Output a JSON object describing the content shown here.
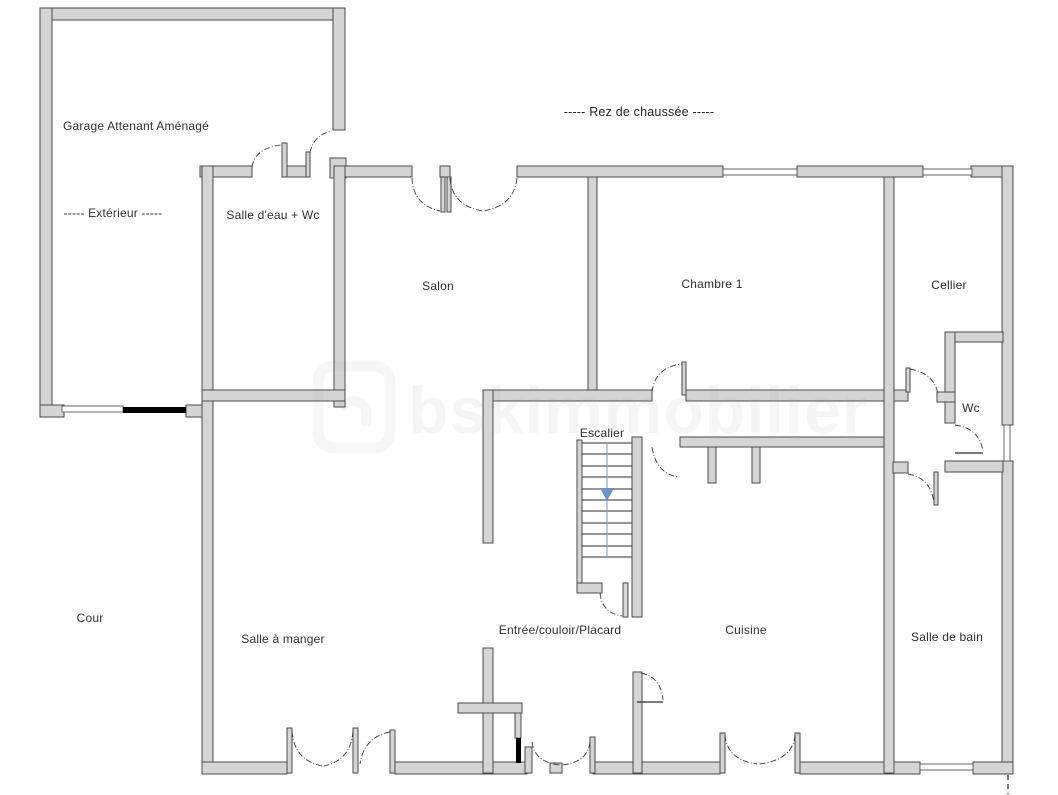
{
  "title": {
    "text": "-----  Rez de chaussée  -----"
  },
  "watermark": {
    "text": "bskimmobilier"
  },
  "rooms": {
    "garage": {
      "label": "Garage Attenant Aménagé"
    },
    "exterieur": {
      "label": "-----  Extérieur  -----"
    },
    "salle_deau": {
      "label": "Salle d'eau + Wc"
    },
    "salon": {
      "label": "Salon"
    },
    "chambre1": {
      "label": "Chambre 1"
    },
    "cellier": {
      "label": "Cellier"
    },
    "wc": {
      "label": "Wc"
    },
    "escalier": {
      "label": "Escalier"
    },
    "entree": {
      "label": "Entrée/couloir/Placard"
    },
    "cuisine": {
      "label": "Cuisine"
    },
    "salle_a_manger": {
      "label": "Salle à manger"
    },
    "salle_de_bain": {
      "label": "Salle de bain"
    },
    "cour": {
      "label": "Cour"
    }
  },
  "colors": {
    "wall_fill": "#d5d5d5",
    "wall_stroke": "#4a4a4a",
    "door_line": "#3a3a3a",
    "window_line": "#555555",
    "stair_line": "#2b2b2b",
    "stair_arrow": "#6b94c4",
    "label_text": "#2f2f2f",
    "garage_door_black": "#000000"
  }
}
